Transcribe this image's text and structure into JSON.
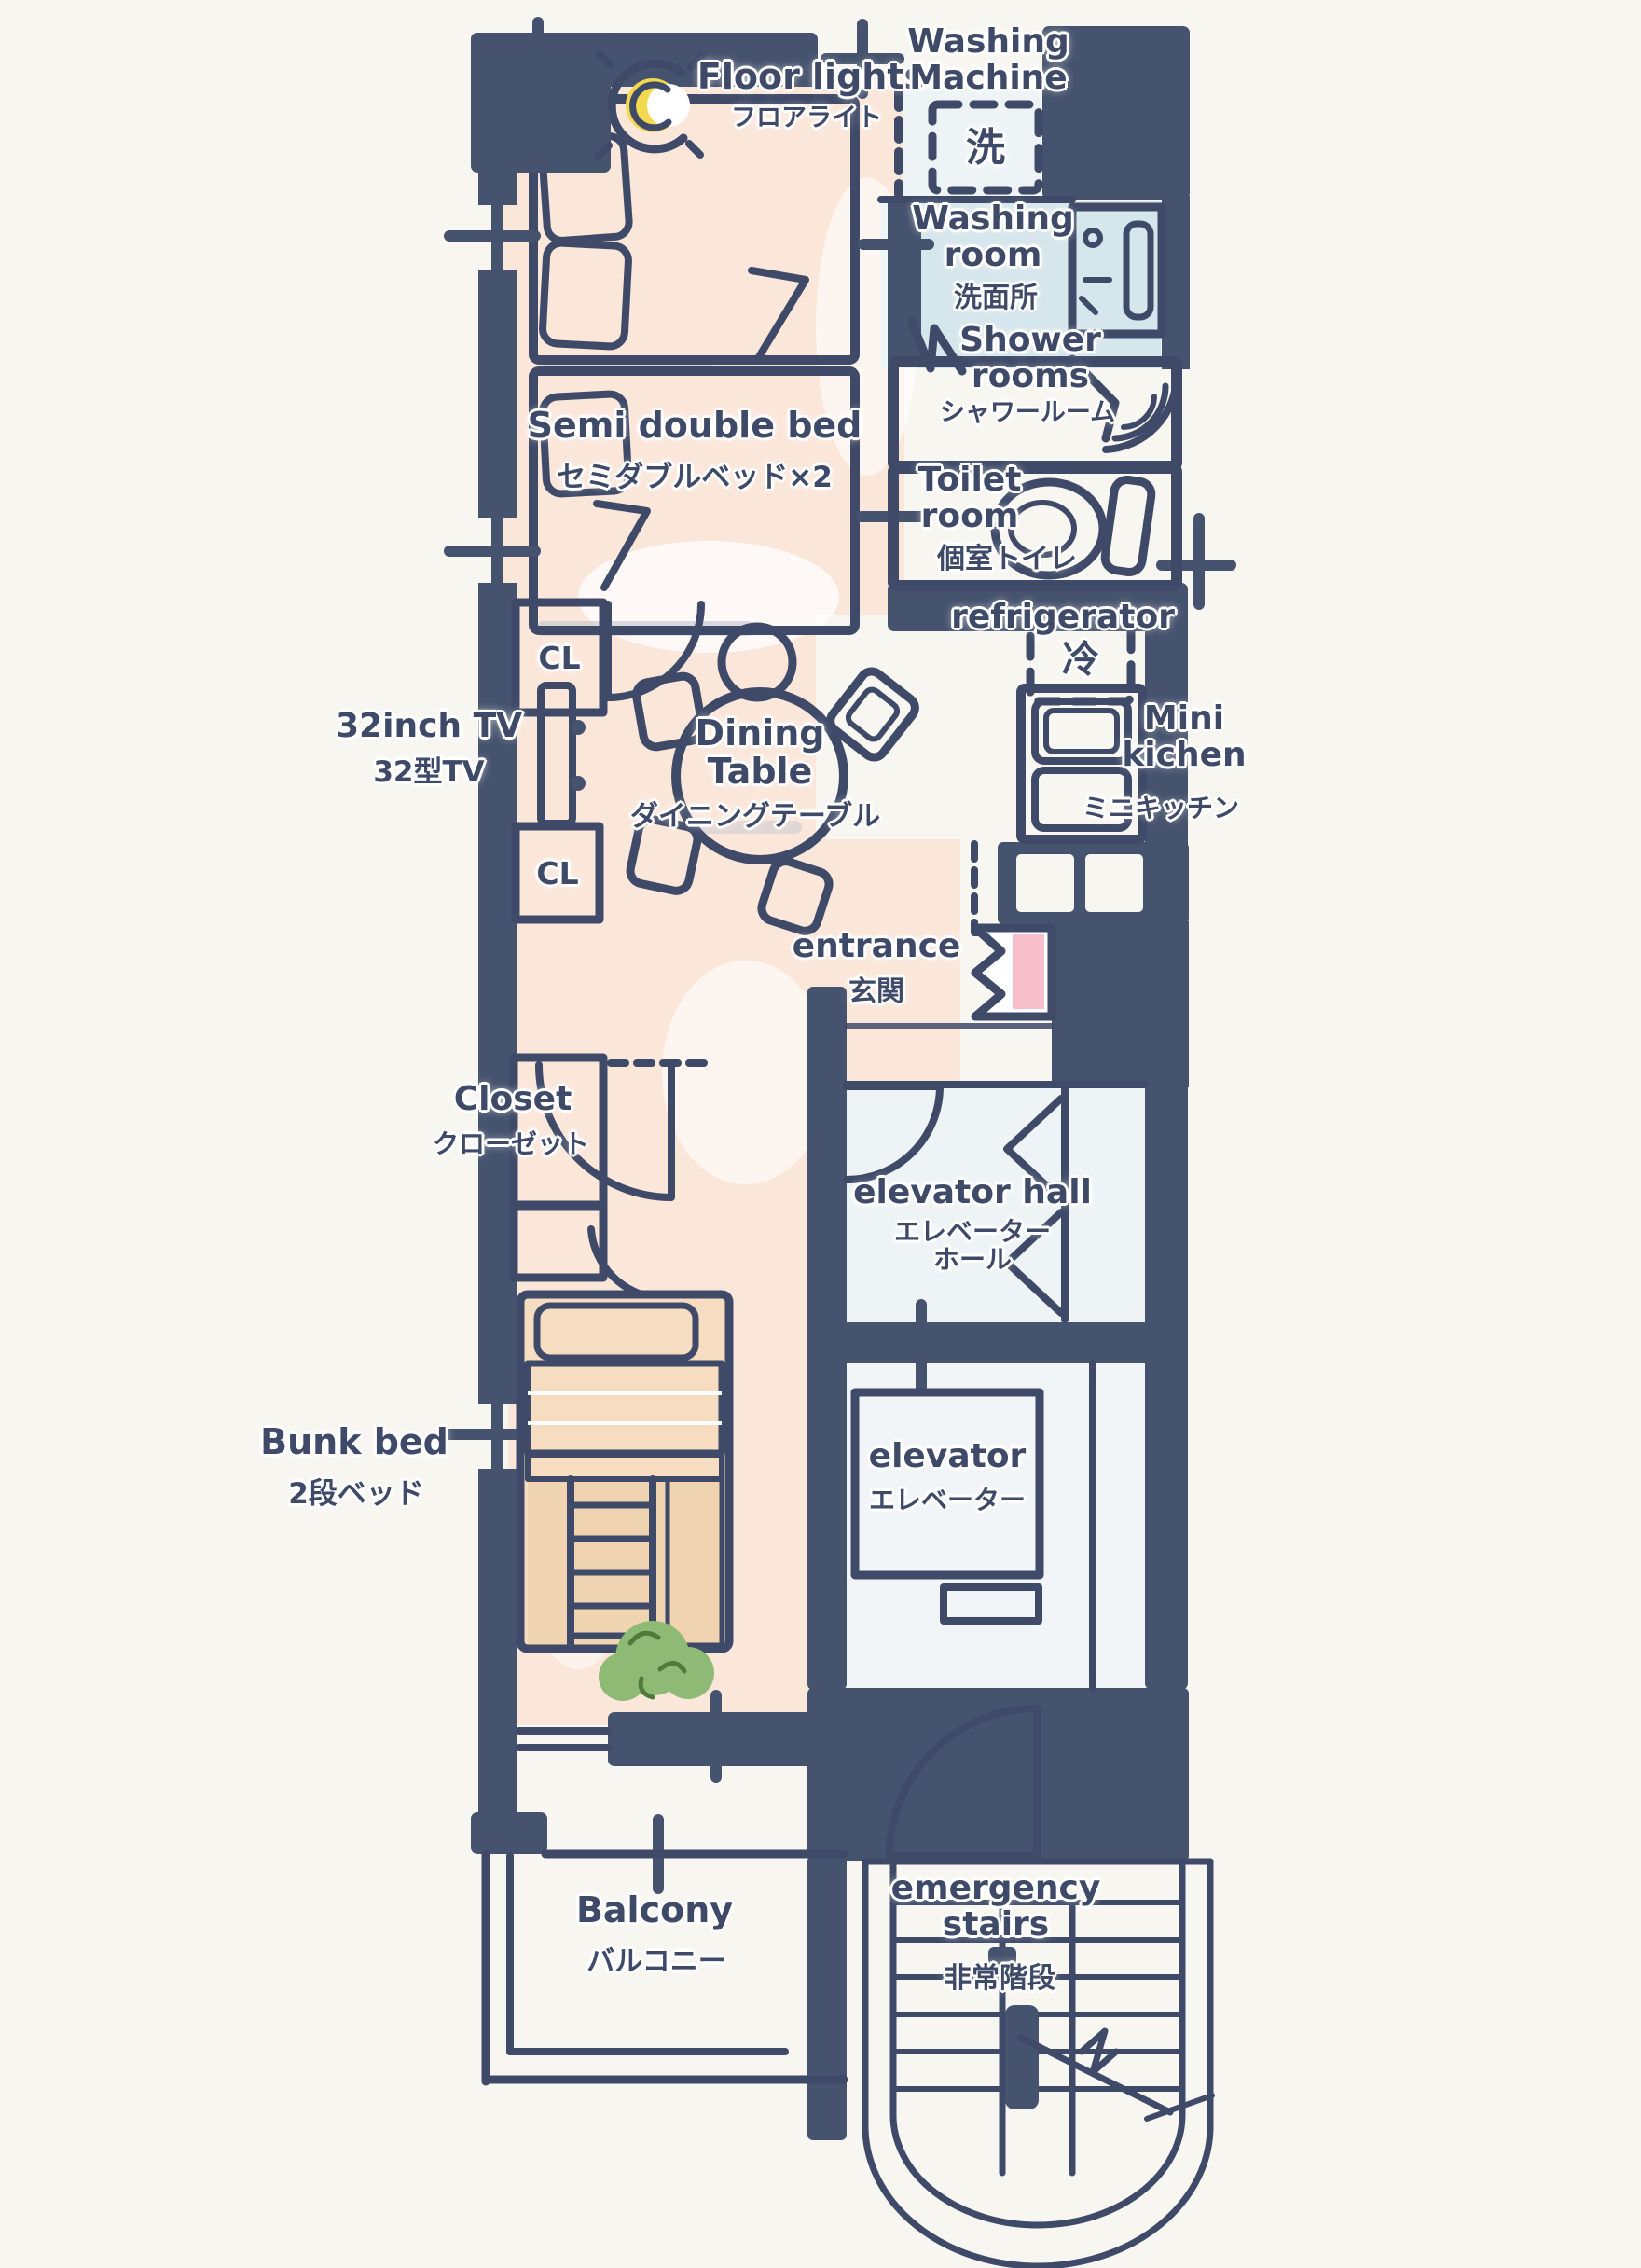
{
  "title": "Hand-drawn apartment floor plan",
  "colors": {
    "paper": "#f8f6f1",
    "ink": "#3e4a68",
    "wall": "#46536e",
    "floor": "#fbe6da",
    "bed_yellow": "#f7ecb2",
    "pillow_yellow": "#f1e193",
    "water_blue": "#d5e6ec",
    "light_blue": "#d9e9ef",
    "pale_blue": "#e3edf1",
    "closet_pink": "#f8cdd3",
    "accent_pink": "#f6bfca",
    "moon_yellow": "#f2d94e",
    "plant_green": "#8fba76",
    "plant_dark": "#4e7a3a",
    "wood_tan": "#f0d4b2",
    "wood_light": "#f6ddc2",
    "band_tan": "#eecba4",
    "shadow_gray": "#b9c0cc",
    "hall_floor": "#eef3f6"
  },
  "labels": {
    "floor_lights": {
      "en": "Floor lights",
      "ja": "フロアライト"
    },
    "washing_machine": {
      "en": "Washing Machine",
      "ja": "洗"
    },
    "washing_room": {
      "en": "Washing room",
      "ja": "洗面所"
    },
    "shower_rooms": {
      "en": "Shower rooms",
      "ja": "シャワールーム"
    },
    "semi_double_bed": {
      "en": "Semi double bed",
      "ja": "セミダブルベッド×2"
    },
    "toilet_room": {
      "en": "Toilet room",
      "ja": "個室トイレ"
    },
    "refrigerator": {
      "en": "refrigerator",
      "ja": "冷"
    },
    "tv": {
      "en": "32inch TV",
      "ja": "32型TV"
    },
    "closet_upper": {
      "en": "CL"
    },
    "closet_lower": {
      "en": "CL"
    },
    "dining_table": {
      "en": "Dining Table",
      "ja": "ダイニングテーブル"
    },
    "mini_kitchen": {
      "en": "Mini kichen",
      "ja": "ミニキッチン"
    },
    "entrance": {
      "en": "entrance",
      "ja": "玄関"
    },
    "closet": {
      "en": "Closet",
      "ja": "クローゼット"
    },
    "elevator_hall": {
      "en": "elevator hall",
      "ja": "エレベーターホール"
    },
    "bunk_bed": {
      "en": "Bunk bed",
      "ja": "2段ベッド"
    },
    "elevator": {
      "en": "elevator",
      "ja": "エレベーター"
    },
    "balcony": {
      "en": "Balcony",
      "ja": "バルコニー"
    },
    "emergency_stairs": {
      "en": "emergency stairs",
      "ja": "非常階段"
    }
  }
}
